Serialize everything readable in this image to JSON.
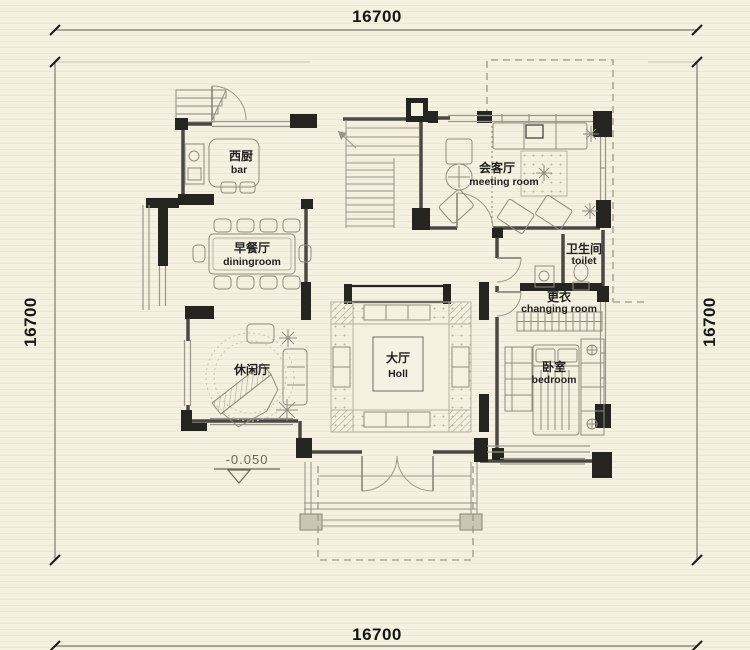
{
  "drawing": {
    "kind": "residential floor plan"
  },
  "dimensions": {
    "top": "16700",
    "bottom": "16700",
    "left": "16700",
    "right": "16700"
  },
  "elevation": {
    "label": "-0.050"
  },
  "rooms": {
    "bar": {
      "cn": "西厨",
      "en": "bar"
    },
    "dining": {
      "cn": "早餐厅",
      "en": "diningroom"
    },
    "leisure": {
      "cn": "休闲厅",
      "en": ""
    },
    "hall": {
      "cn": "大厅",
      "en": "Holl"
    },
    "meeting": {
      "cn": "会客厅",
      "en": "meeting room"
    },
    "toilet": {
      "cn": "卫生间",
      "en": "toilet"
    },
    "changing": {
      "cn": "更衣",
      "en": "changing room"
    },
    "bedroom": {
      "cn": "卧室",
      "en": "bedroom"
    }
  },
  "colors": {
    "paper": "#f4f1e1",
    "paper_stripe": "#ebe7d4",
    "wall_black": "#26241f",
    "wall_gray": "#4a4842",
    "thin_line": "#9a978a",
    "furniture_line": "#8f8c80",
    "dot_pattern": "#b7b3a2",
    "dim_text": "#161613",
    "muted_text": "#6b685c"
  }
}
